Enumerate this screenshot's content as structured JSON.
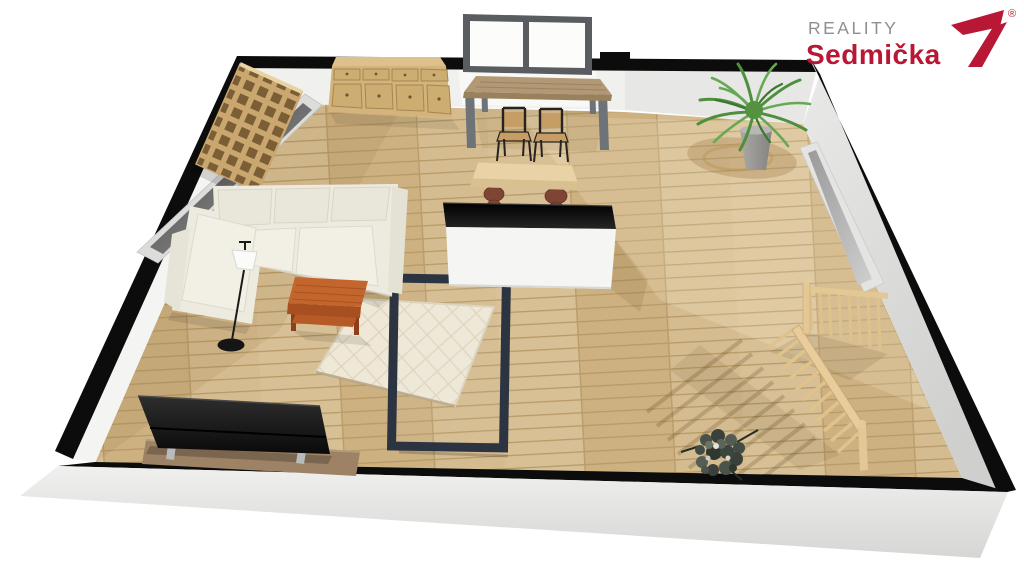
{
  "brand": {
    "line1": "REALITY",
    "line2": "Sedmička",
    "registered": "®"
  },
  "colors": {
    "brand_red": "#b81735",
    "brand_gray": "#8d8f93",
    "background": "#ffffff",
    "wall_cut": "#0c0c0c",
    "wall_face_light": "#f0f0ee",
    "wall_face_mid": "#e7e7e5",
    "wall_exterior": "#e3e3e1",
    "floor_base": "#d2b98c",
    "plank_seam": "#b79a67",
    "wood_light": "#ddc08b",
    "wood_mid": "#d3b47c",
    "wood_dark": "#7b5d36",
    "sofa": "#edeadf",
    "sofa_cushion": "#f2efe5",
    "rug": "#efe8d7",
    "rug_line": "#ded5bd",
    "accent_orange": "#c2662e",
    "frame_dark": "#2b3440",
    "island_body": "#f5f5f4",
    "island_top": "#101010",
    "tv_black": "#161616",
    "console_brown": "#9d8265",
    "railing_wood": "#e3c794",
    "plant_green": "#4e8f3e",
    "glass_gray": "#8a8a8a",
    "metal_gray": "#6e7378"
  },
  "scene": {
    "view": "3d-perspective-floor-plan",
    "room_objects": [
      "sectional-sofa",
      "coffee-table",
      "area-rug",
      "glass-frame-table",
      "tv-on-console",
      "floor-lamp",
      "kitchen-island",
      "wooden-bench",
      "dining-table",
      "dining-chairs",
      "chest-of-drawers",
      "bookshelf",
      "potted-palm",
      "flower-bouquet",
      "stair-railing",
      "back-window",
      "left-window",
      "right-window"
    ]
  }
}
